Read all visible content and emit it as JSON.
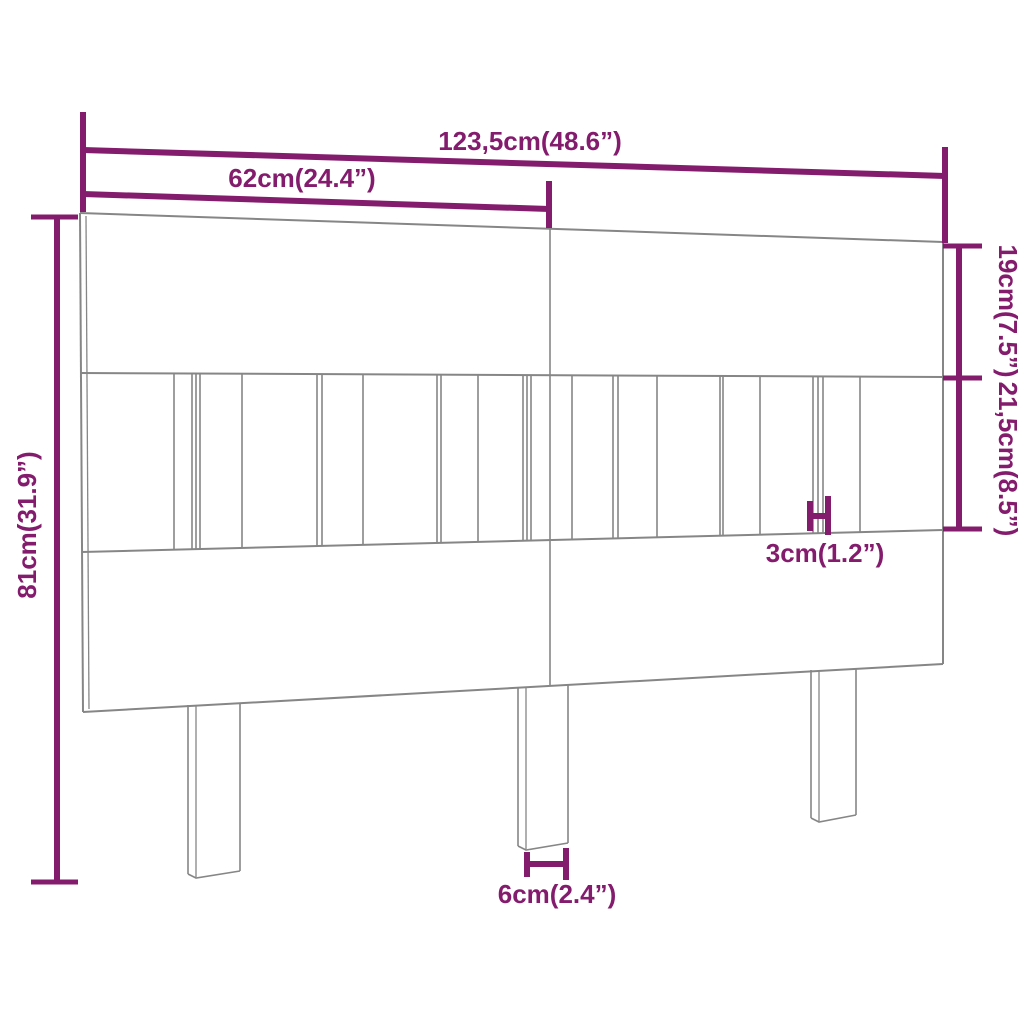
{
  "dimensions": {
    "total_width": "123,5cm(48.6”)",
    "panel_width": "62cm(24.4”)",
    "top_board_height": "19cm(7.5”)",
    "slat_section_height": "21,5cm(8.5”)",
    "total_height": "81cm(31.9”)",
    "slat_width": "3cm(1.2”)",
    "leg_width": "6cm(2.4”)"
  },
  "colors": {
    "dimension_accent": "#841c6e",
    "outline_gray": "#868686"
  }
}
